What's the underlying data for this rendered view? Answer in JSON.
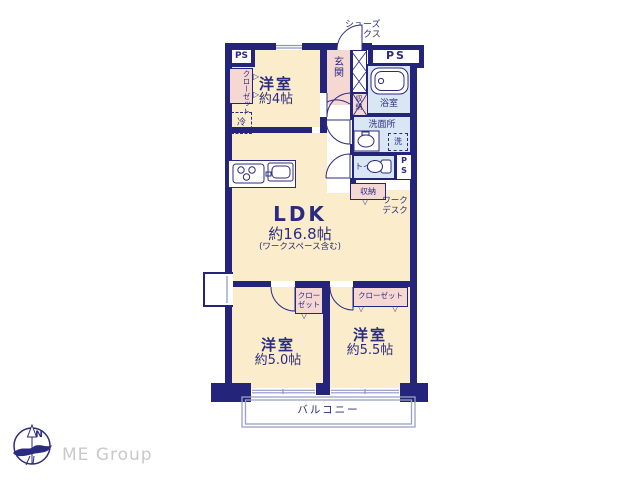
{
  "floorplan": {
    "rooms": {
      "ldk": {
        "name": "LDK",
        "size": "約16.8帖",
        "note": "(ワークスペース含む)"
      },
      "bedroom_4": {
        "name": "洋室",
        "size": "約4帖"
      },
      "bedroom_50": {
        "name": "洋室",
        "size": "約5.0帖"
      },
      "bedroom_55": {
        "name": "洋室",
        "size": "約5.5帖"
      },
      "entrance": "玄関",
      "bathroom": "浴室",
      "washroom": "洗面所",
      "toilet": "トイレ",
      "balcony": "バルコニー"
    },
    "fixtures": {
      "ps": "PS",
      "ps_vertical": {
        "line1": "P",
        "line2": "S"
      },
      "shoe_box": {
        "line1": "シューズ",
        "line2": "ボックス"
      },
      "storage": "収納",
      "closet": "クローゼット",
      "closet_2line": {
        "line1": "クロー",
        "line2": "ゼット"
      },
      "work_desk": {
        "line1": "ワーク",
        "line2": "デスク"
      },
      "refrigerator": "冷",
      "washing_machine": "洗"
    },
    "markers": {
      "fold_right": "▷",
      "fold_down": "▽",
      "north": "N"
    },
    "branding": {
      "company": "ME Group"
    },
    "colors": {
      "wall": "#24247b",
      "text": "#2b2b80",
      "floor": "#fbedcb",
      "wet_area": "#d9e7f4",
      "closet": "#f6d8d2",
      "window_line": "#8d96c2",
      "balcony_line": "#99a2c4",
      "brand_text": "#c9c9c9"
    }
  }
}
